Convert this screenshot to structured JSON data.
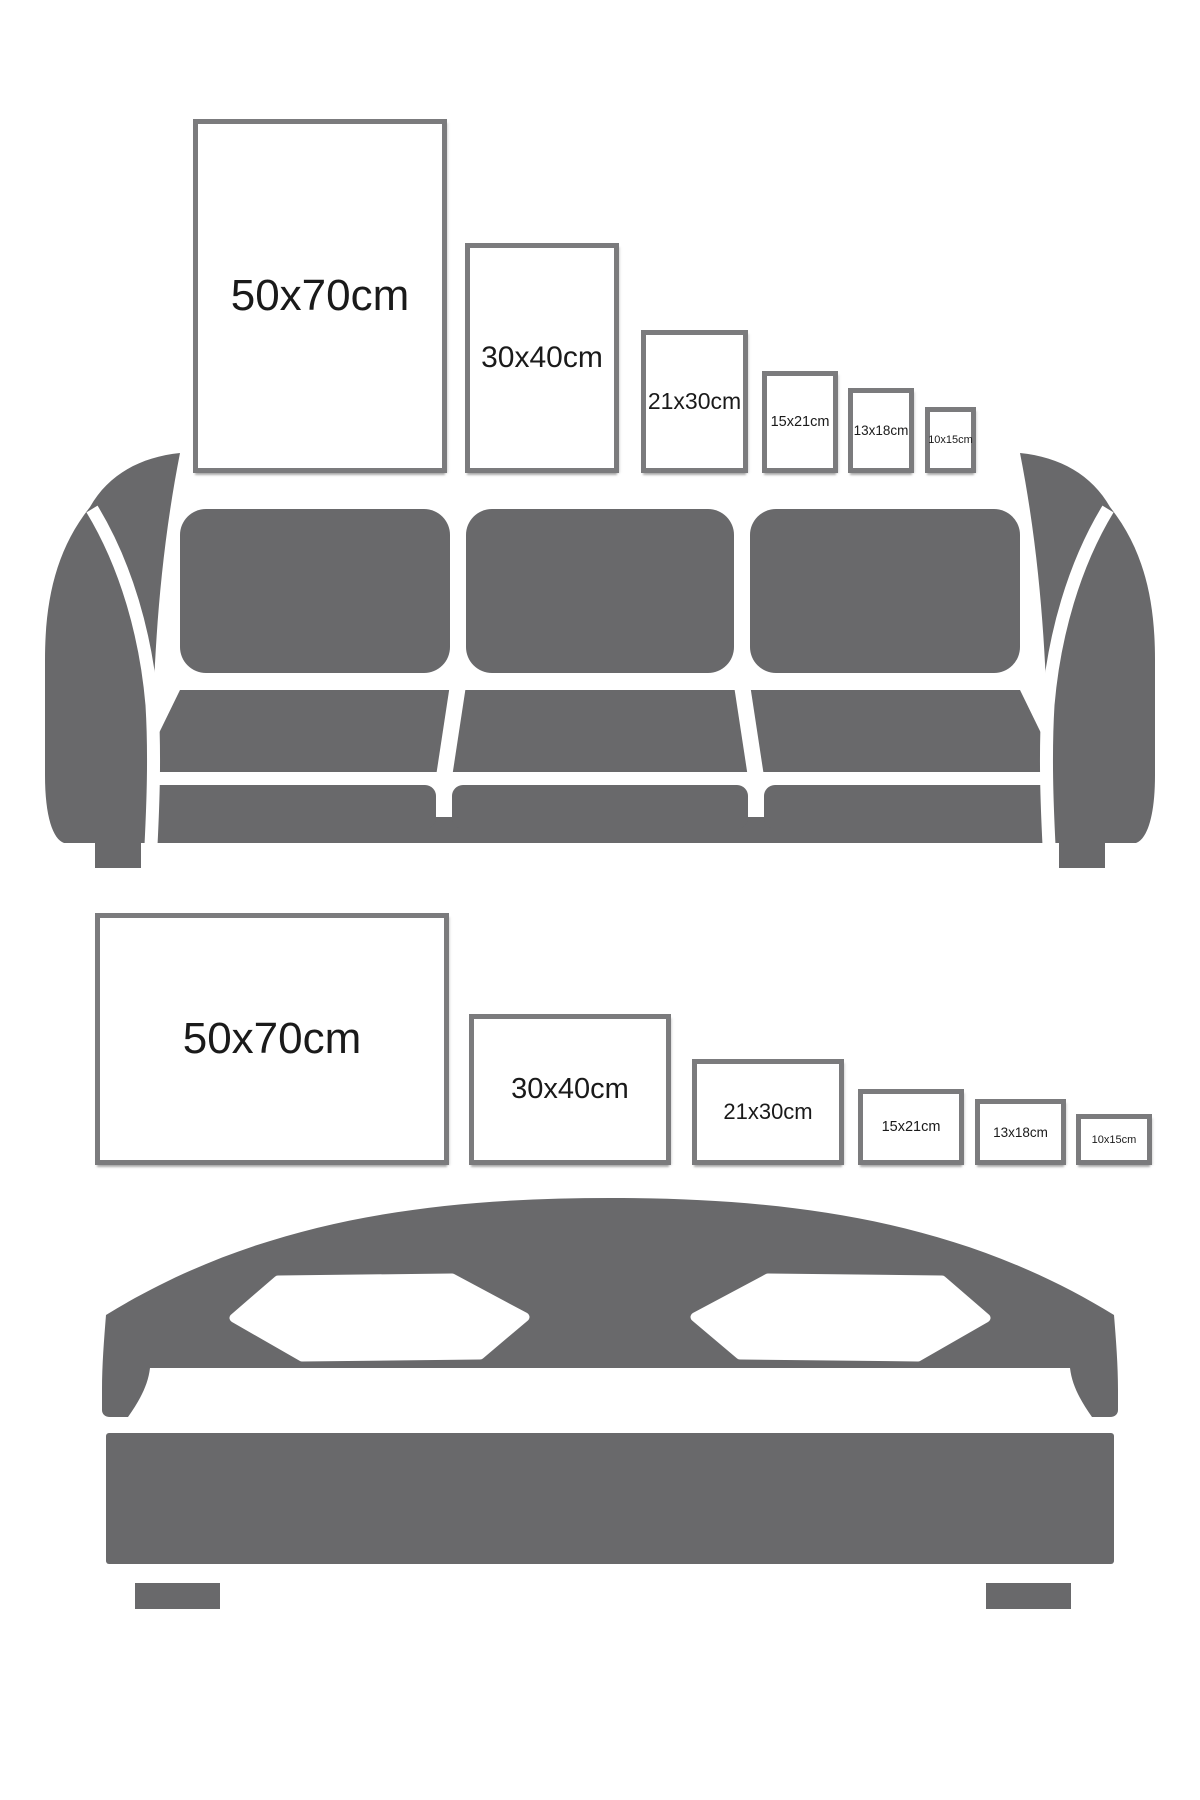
{
  "title": "Poster frame size comparison guide",
  "colors": {
    "figure": "#69696b",
    "frame_border": "#7b7b7d",
    "text": "#1a1a1a",
    "bg": "#ffffff"
  },
  "portrait_row": {
    "orientation": "portrait",
    "frames": [
      {
        "label": "50x70cm"
      },
      {
        "label": "30x40cm"
      },
      {
        "label": "21x30cm"
      },
      {
        "label": "15x21cm"
      },
      {
        "label": "13x18cm"
      },
      {
        "label": "10x15cm"
      }
    ]
  },
  "landscape_row": {
    "orientation": "landscape",
    "frames": [
      {
        "label": "50x70cm"
      },
      {
        "label": "30x40cm"
      },
      {
        "label": "21x30cm"
      },
      {
        "label": "15x21cm"
      },
      {
        "label": "13x18cm"
      },
      {
        "label": "10x15cm"
      }
    ]
  },
  "illustrations": {
    "sofa": "three-seat sofa silhouette",
    "bed": "double bed silhouette"
  }
}
